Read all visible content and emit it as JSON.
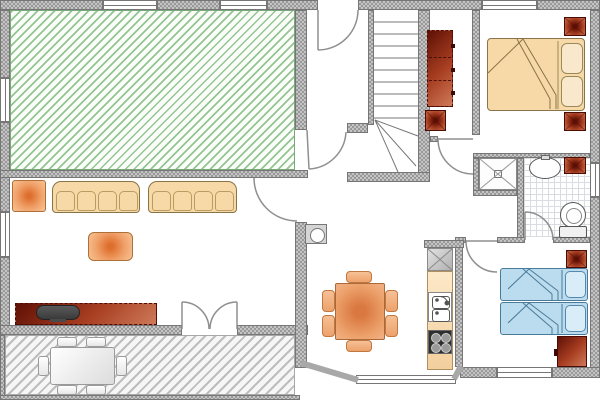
{
  "document": {
    "kind": "architectural-floor-plan",
    "text_labels": "none visible in drawing",
    "canvas": {
      "width_px": 600,
      "height_px": 400
    }
  },
  "colors": {
    "wall_fill": "#c4c4c4",
    "wall_dot": "#999999",
    "wall_border": "#767676",
    "green_bg": "#fafdf8",
    "green_line": "#93c493",
    "terrace_bg": "#f6f6f6",
    "terrace_line": "#bdbdbd",
    "tile_line": "#d9dde2",
    "tan_fill": "#f6d9a6",
    "tan_light": "#f9e8cb",
    "tan_border": "#8a7348",
    "orange_core": "#dd6f2e",
    "orange_edge": "#f7c596",
    "orange_border": "#ad7038",
    "red_dark": "#5f1005",
    "red_mid": "#a93f22",
    "red_light": "#cd7a5a",
    "blue_fill": "#badcee",
    "blue_light": "#d8edf7",
    "blue_border": "#4a7a9a",
    "line_color": "#8f8f8f",
    "tv_dark": "#3a3a3a",
    "stove_dark": "#2f2f2f"
  },
  "rooms": [
    {
      "id": "green-room",
      "hint": "large top-left room, green diagonal hatch floor, 2 top windows + 2 left windows"
    },
    {
      "id": "living-room",
      "hint": "left middle; 2 sofas, 2 orange pads, sideboard with TV, door to hall, double door to terrace"
    },
    {
      "id": "entrance-hall",
      "hint": "top middle; front door in top wall, red wardrobe and red cabinet"
    },
    {
      "id": "staircase",
      "hint": "center; straight run with winder treads at bottom"
    },
    {
      "id": "kitchen-dining",
      "hint": "bottom middle; square table with 6 chairs, counter run with fridge, sink, stove, bay window, wall boiler"
    },
    {
      "id": "bedroom-double",
      "hint": "top right; double bed, 2 red nightstands, window in top wall"
    },
    {
      "id": "bathroom",
      "hint": "right middle; tiled floor, X-marked shower, oval sink, red bin, toilet"
    },
    {
      "id": "bedroom-twin",
      "hint": "bottom right; two blue single beds, red nightstand and dresser, bottom window"
    },
    {
      "id": "terrace",
      "hint": "bottom-left strip, gray diagonal hatch, white dining table with 6 chairs"
    }
  ],
  "furniture": {
    "living_room": [
      "orange-floor-pad",
      "sofa-4-seat",
      "sofa-4-seat",
      "orange-coffee-table",
      "sideboard-dark-red",
      "tv-set"
    ],
    "terrace": [
      "white-table",
      "white-chair x6"
    ],
    "entrance_hall": [
      "wardrobe-dark-red",
      "cabinet-dark-red"
    ],
    "kitchen_dining": [
      "wall-boiler",
      "fridge",
      "counter",
      "double-sink",
      "stove-4-burners",
      "dining-table-orange",
      "dining-chair x6"
    ],
    "bedroom_double": [
      "double-bed-tan",
      "pillow x2",
      "nightstand-red x2"
    ],
    "bathroom": [
      "shower-cabin",
      "wash-basin-oval",
      "laundry-box-red",
      "toilet"
    ],
    "bedroom_twin": [
      "single-bed-blue x2",
      "pillow x2",
      "nightstand-red",
      "dresser-dark-red"
    ]
  },
  "openings": {
    "windows": 8,
    "single_doors": 6,
    "double_door": 1,
    "bay_window": 1
  }
}
